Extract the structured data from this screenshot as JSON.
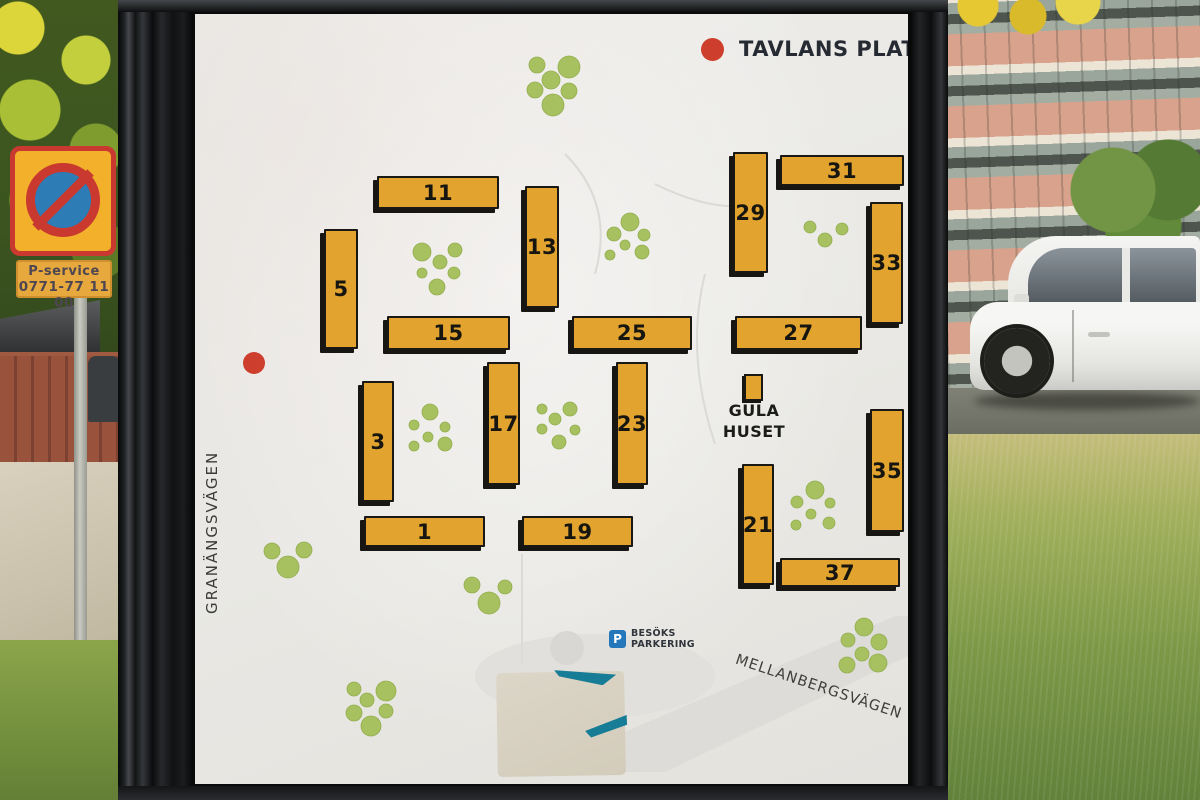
{
  "legend": {
    "title": "TAVLANS PLATS",
    "marker": "red-dot"
  },
  "map": {
    "buildings": [
      {
        "label": "11",
        "x": 182,
        "y": 162,
        "w": 122,
        "h": 33
      },
      {
        "label": "13",
        "x": 330,
        "y": 172,
        "w": 34,
        "h": 122
      },
      {
        "label": "5",
        "x": 129,
        "y": 215,
        "w": 34,
        "h": 120
      },
      {
        "label": "15",
        "x": 192,
        "y": 302,
        "w": 123,
        "h": 34
      },
      {
        "label": "25",
        "x": 377,
        "y": 302,
        "w": 120,
        "h": 34
      },
      {
        "label": "27",
        "x": 540,
        "y": 302,
        "w": 127,
        "h": 34
      },
      {
        "label": "29",
        "x": 538,
        "y": 138,
        "w": 35,
        "h": 121
      },
      {
        "label": "31",
        "x": 585,
        "y": 141,
        "w": 124,
        "h": 31
      },
      {
        "label": "33",
        "x": 675,
        "y": 188,
        "w": 33,
        "h": 122
      },
      {
        "label": "3",
        "x": 167,
        "y": 367,
        "w": 32,
        "h": 121
      },
      {
        "label": "17",
        "x": 292,
        "y": 348,
        "w": 33,
        "h": 123
      },
      {
        "label": "23",
        "x": 421,
        "y": 348,
        "w": 32,
        "h": 123
      },
      {
        "label": "1",
        "x": 169,
        "y": 502,
        "w": 121,
        "h": 31
      },
      {
        "label": "19",
        "x": 327,
        "y": 502,
        "w": 111,
        "h": 31
      },
      {
        "label": "21",
        "x": 547,
        "y": 450,
        "w": 32,
        "h": 121
      },
      {
        "label": "35",
        "x": 675,
        "y": 395,
        "w": 34,
        "h": 123
      },
      {
        "label": "37",
        "x": 585,
        "y": 544,
        "w": 120,
        "h": 29
      }
    ],
    "gula_huset": {
      "line1": "GULA",
      "line2": "HUSET"
    },
    "tree_clusters": [
      [
        [
          342,
          51,
          8
        ],
        [
          374,
          53,
          11
        ],
        [
          356,
          66,
          9
        ],
        [
          340,
          76,
          8
        ],
        [
          374,
          77,
          8
        ],
        [
          358,
          91,
          11
        ]
      ],
      [
        [
          227,
          238,
          9
        ],
        [
          260,
          236,
          7
        ],
        [
          245,
          248,
          7
        ],
        [
          227,
          259,
          5
        ],
        [
          259,
          259,
          6
        ],
        [
          242,
          273,
          8
        ]
      ],
      [
        [
          435,
          208,
          9
        ],
        [
          419,
          220,
          7
        ],
        [
          449,
          221,
          6
        ],
        [
          430,
          231,
          5
        ],
        [
          415,
          241,
          5
        ],
        [
          447,
          238,
          7
        ]
      ],
      [
        [
          615,
          213,
          6
        ],
        [
          647,
          215,
          6
        ],
        [
          630,
          226,
          7
        ]
      ],
      [
        [
          235,
          398,
          8
        ],
        [
          219,
          411,
          5
        ],
        [
          250,
          413,
          5
        ],
        [
          233,
          423,
          5
        ],
        [
          219,
          432,
          5
        ],
        [
          250,
          430,
          7
        ]
      ],
      [
        [
          347,
          395,
          5
        ],
        [
          375,
          395,
          7
        ],
        [
          360,
          405,
          6
        ],
        [
          347,
          415,
          5
        ],
        [
          380,
          416,
          5
        ],
        [
          364,
          428,
          7
        ]
      ],
      [
        [
          620,
          476,
          9
        ],
        [
          602,
          488,
          6
        ],
        [
          635,
          489,
          5
        ],
        [
          616,
          500,
          5
        ],
        [
          601,
          511,
          5
        ],
        [
          634,
          509,
          6
        ]
      ],
      [
        [
          77,
          537,
          8
        ],
        [
          109,
          536,
          8
        ],
        [
          93,
          553,
          11
        ]
      ],
      [
        [
          277,
          571,
          8
        ],
        [
          310,
          573,
          7
        ],
        [
          294,
          589,
          11
        ]
      ],
      [
        [
          159,
          675,
          7
        ],
        [
          191,
          677,
          10
        ],
        [
          172,
          686,
          7
        ],
        [
          159,
          699,
          8
        ],
        [
          191,
          697,
          7
        ],
        [
          176,
          712,
          10
        ]
      ],
      [
        [
          669,
          613,
          9
        ],
        [
          653,
          626,
          7
        ],
        [
          684,
          628,
          8
        ],
        [
          667,
          640,
          7
        ],
        [
          652,
          651,
          8
        ],
        [
          683,
          649,
          9
        ]
      ]
    ],
    "streets": [
      {
        "name": "GRANÄNGSVÄGEN"
      },
      {
        "name": "MELLANBERGSVÄGEN"
      }
    ],
    "visitor_parking": {
      "icon_letter": "P",
      "line1": "BESÖKS",
      "line2": "PARKERING"
    }
  },
  "roadside_sign": {
    "line1": "P-service",
    "line2": "0771-77 11 00"
  },
  "colors": {
    "building_fill": "#E2A42F",
    "tree_green": "#A7C161",
    "marker_red": "#CE3E2D",
    "parking_blue": "#2577BB",
    "map_background": "#EAE9E5",
    "legend_text": "#262A33"
  }
}
